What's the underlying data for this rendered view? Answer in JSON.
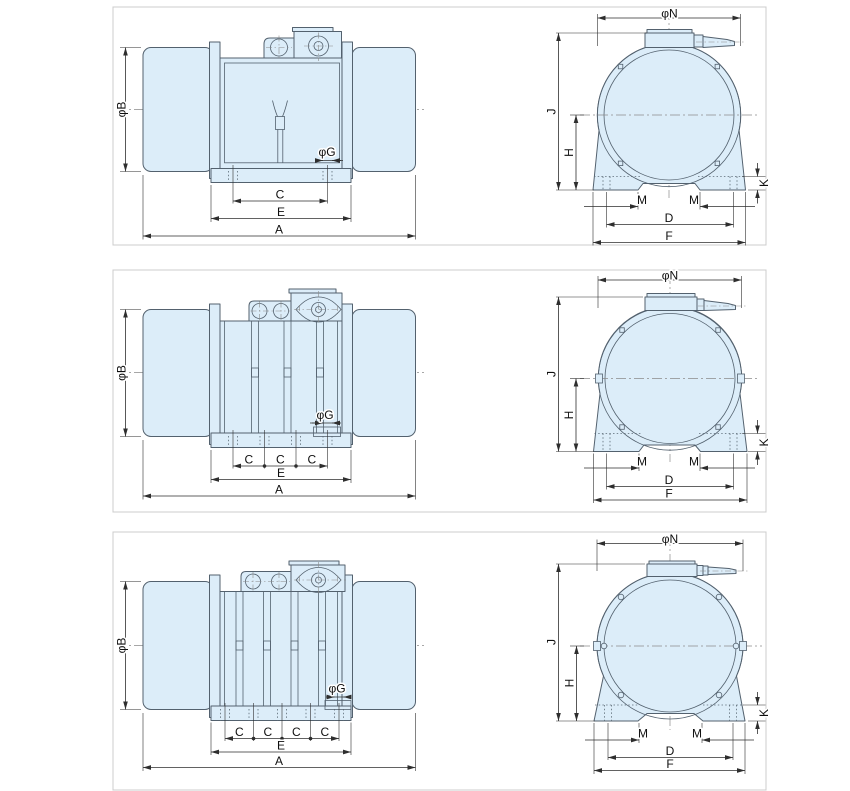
{
  "colors": {
    "background": "#ffffff",
    "panel_border": "#cccccc",
    "body_fill": "#dcedf9",
    "outline": "#53616e",
    "dimension": "#2e2e2e",
    "centerline": "#8a8a8a"
  },
  "rows": [
    {
      "side_view": {
        "diameter_b": "φB",
        "diameter_g": "φG",
        "c_segments": [
          "C"
        ],
        "e": "E",
        "a": "A"
      },
      "end_view": {
        "diameter_n": "φN",
        "j": "J",
        "h": "H",
        "k": "K",
        "m_left": "M",
        "m_right": "M",
        "d": "D",
        "f": "F"
      }
    },
    {
      "side_view": {
        "diameter_b": "φB",
        "diameter_g": "φG",
        "c_segments": [
          "C",
          "C",
          "C"
        ],
        "e": "E",
        "a": "A"
      },
      "end_view": {
        "diameter_n": "φN",
        "j": "J",
        "h": "H",
        "k": "K",
        "m_left": "M",
        "m_right": "M",
        "d": "D",
        "f": "F"
      }
    },
    {
      "side_view": {
        "diameter_b": "φB",
        "diameter_g": "φG",
        "c_segments": [
          "C",
          "C",
          "C",
          "C"
        ],
        "e": "E",
        "a": "A"
      },
      "end_view": {
        "diameter_n": "φN",
        "j": "J",
        "h": "H",
        "k": "K",
        "m_left": "M",
        "m_right": "M",
        "d": "D",
        "f": "F"
      }
    }
  ]
}
